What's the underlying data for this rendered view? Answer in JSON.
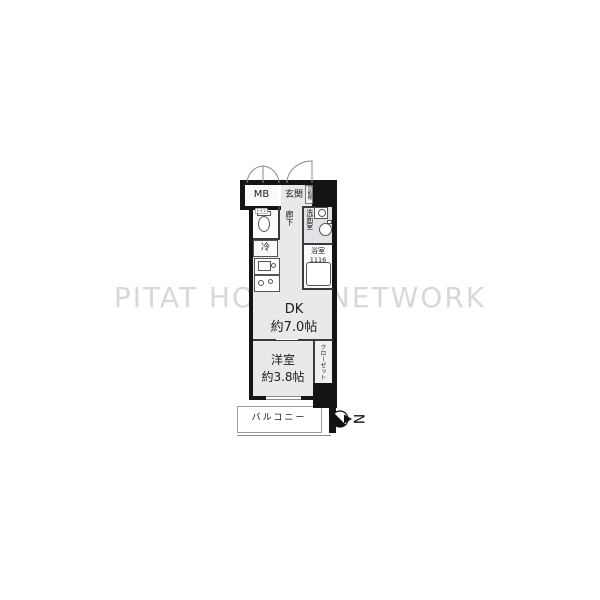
{
  "watermark": "PITAT HOUSE NETWORK",
  "compass": {
    "north_letter": "N"
  },
  "rooms": {
    "mb": {
      "label": "MB"
    },
    "genkan": {
      "label": "玄関"
    },
    "movable_shelf": {
      "label": "可動棚"
    },
    "toilet": {
      "label": "トイレ"
    },
    "corridor": {
      "label": "廊下"
    },
    "washroom": {
      "label": "洗面室"
    },
    "washer": {
      "label": "洗濯機"
    },
    "fridge": {
      "label": "冷"
    },
    "bathroom": {
      "label": "浴室",
      "size": "1116"
    },
    "dk": {
      "label": "DK",
      "size": "約7.0帖"
    },
    "western_room": {
      "label": "洋室",
      "size": "約3.8帖"
    },
    "closet": {
      "label": "クローゼット"
    },
    "balcony": {
      "label": "バルコニー"
    }
  },
  "colors": {
    "wall": "#141414",
    "floor": "#e9e9ec",
    "watermark": "#d8d8d8"
  }
}
